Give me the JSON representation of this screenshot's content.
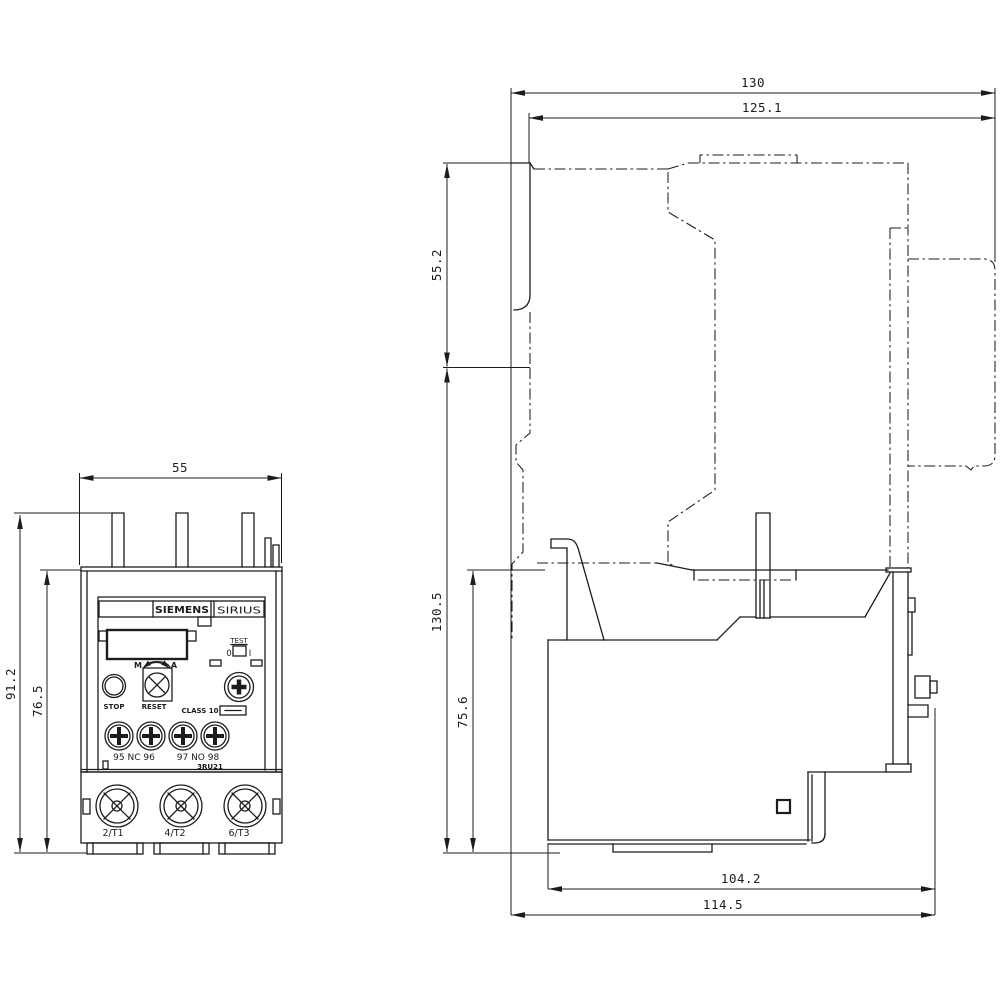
{
  "meta": {
    "drawing_type": "dimensional-drawing",
    "background_color": "#ffffff",
    "line_color": "#1c1c1c"
  },
  "front_view": {
    "labels": {
      "brand": "SIEMENS",
      "series": "SIRIUS",
      "test": "TEST",
      "test_off": "0",
      "test_on": "I",
      "manual": "M",
      "auto": "A",
      "stop": "STOP",
      "reset": "RESET",
      "class_rating": "CLASS 10",
      "aux_terminals_nc": "95 NC 96",
      "aux_terminals_no": "97 NO 98",
      "model": "3RU21",
      "main_terminals": [
        "2/T1",
        "4/T2",
        "6/T3"
      ]
    },
    "dimensions": {
      "width": "55",
      "total_height": "91.2",
      "body_height": "76.5"
    }
  },
  "side_view": {
    "dimensions": {
      "total_depth": "130",
      "inner_depth": "125.1",
      "upper_height": "55.2",
      "lower_height": "130.5",
      "relay_height": "75.6",
      "relay_depth": "104.2",
      "lower_depth": "114.5"
    }
  }
}
